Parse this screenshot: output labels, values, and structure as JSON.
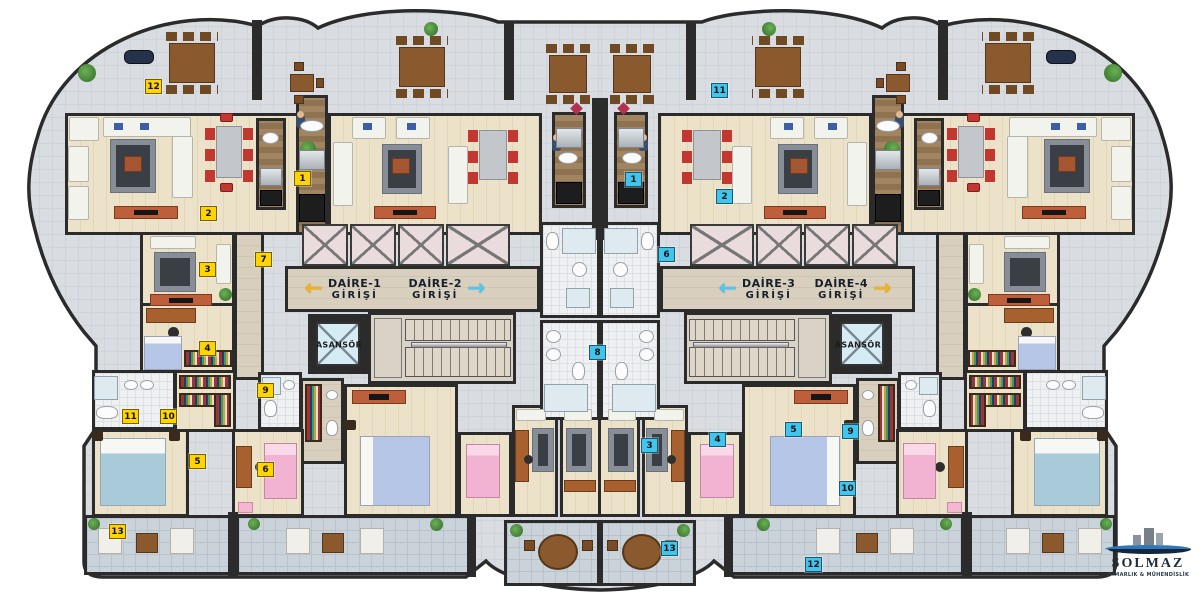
{
  "plan": {
    "company": {
      "name": "SOLMAZ",
      "subtitle": "MİMARLIK & MÜHENDİSLİK"
    },
    "entrance_signs": [
      {
        "label": "DAİRE-1",
        "sublabel": "GİRİŞİ",
        "arrow": "←",
        "arrow_color": "#f2b21e",
        "arrow_side": "left",
        "x": 343,
        "y": 289
      },
      {
        "label": "DAİRE-2",
        "sublabel": "GİRİŞİ",
        "arrow": "→",
        "arrow_color": "#52c5f0",
        "arrow_side": "right",
        "x": 447,
        "y": 289
      },
      {
        "label": "DAİRE-3",
        "sublabel": "GİRİŞİ",
        "arrow": "←",
        "arrow_color": "#52c5f0",
        "arrow_side": "left",
        "x": 757,
        "y": 289
      },
      {
        "label": "DAİRE-4",
        "sublabel": "GİRİŞİ",
        "arrow": "→",
        "arrow_color": "#f2b21e",
        "arrow_side": "right",
        "x": 853,
        "y": 289
      }
    ],
    "elevator_labels": [
      {
        "label": "ASANSÖR",
        "x": 339,
        "y": 345
      },
      {
        "label": "ASANSÖR",
        "x": 858,
        "y": 345
      }
    ],
    "room_badges": [
      {
        "number": "12",
        "color": "yellow",
        "x": 152,
        "y": 85
      },
      {
        "number": "1",
        "color": "yellow",
        "x": 301,
        "y": 177
      },
      {
        "number": "2",
        "color": "yellow",
        "x": 207,
        "y": 212
      },
      {
        "number": "3",
        "color": "yellow",
        "x": 206,
        "y": 268
      },
      {
        "number": "7",
        "color": "yellow",
        "x": 262,
        "y": 258
      },
      {
        "number": "4",
        "color": "yellow",
        "x": 206,
        "y": 347
      },
      {
        "number": "9",
        "color": "yellow",
        "x": 264,
        "y": 389
      },
      {
        "number": "11",
        "color": "yellow",
        "x": 129,
        "y": 415
      },
      {
        "number": "10",
        "color": "yellow",
        "x": 167,
        "y": 415
      },
      {
        "number": "5",
        "color": "yellow",
        "x": 196,
        "y": 460
      },
      {
        "number": "6",
        "color": "yellow",
        "x": 264,
        "y": 468
      },
      {
        "number": "13",
        "color": "yellow",
        "x": 116,
        "y": 530
      },
      {
        "number": "11",
        "color": "blue",
        "x": 718,
        "y": 89
      },
      {
        "number": "1",
        "color": "blue",
        "x": 632,
        "y": 178
      },
      {
        "number": "2",
        "color": "blue",
        "x": 723,
        "y": 195
      },
      {
        "number": "6",
        "color": "blue",
        "x": 665,
        "y": 253
      },
      {
        "number": "8",
        "color": "blue",
        "x": 596,
        "y": 351
      },
      {
        "number": "3",
        "color": "blue",
        "x": 648,
        "y": 444
      },
      {
        "number": "4",
        "color": "blue",
        "x": 716,
        "y": 438
      },
      {
        "number": "5",
        "color": "blue",
        "x": 792,
        "y": 428
      },
      {
        "number": "9",
        "color": "blue",
        "x": 849,
        "y": 430
      },
      {
        "number": "10",
        "color": "blue",
        "x": 846,
        "y": 487
      },
      {
        "number": "13",
        "color": "blue",
        "x": 668,
        "y": 547
      },
      {
        "number": "12",
        "color": "blue",
        "x": 812,
        "y": 563
      }
    ],
    "colors": {
      "wall": "#2b2b2b",
      "floor_tile": "#d9dde2",
      "wood_floor": "#ece2ca",
      "badge_yellow": "#ffd400",
      "badge_blue": "#40c6ee",
      "arrow_yellow": "#f2b21e",
      "arrow_blue": "#52c5f0"
    }
  }
}
